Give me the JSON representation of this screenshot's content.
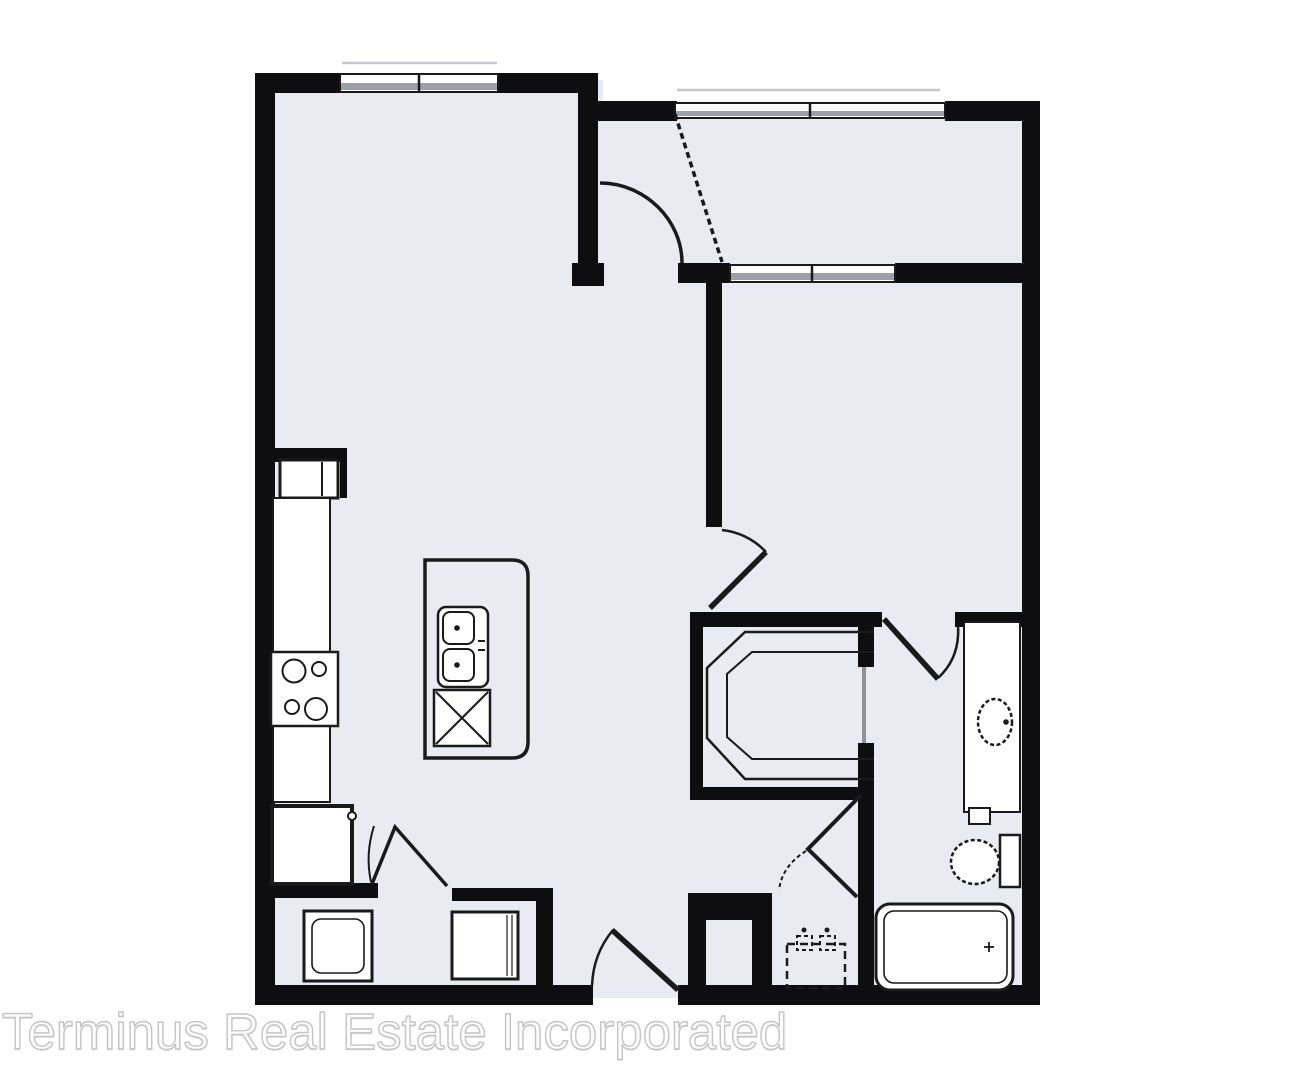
{
  "watermark": {
    "text": "Terminus Real Estate Incorporated"
  },
  "colors": {
    "wall": "#0e0e10",
    "floor": "#e8ebf1",
    "line": "#1a1a1c",
    "window_gray": "#9aa0a8",
    "faint": "#c3c7cd",
    "thin_door": "#8d929a",
    "fixture_fill": "#ffffff",
    "wm_stroke": "#c4c4c4",
    "wm_fill": "#fdfdfd"
  },
  "plan": {
    "type": "apartment-floor-plan",
    "rooms_depicted": [
      "living-dining-room",
      "kitchen",
      "balcony",
      "bedroom",
      "walk-in-closet",
      "bathroom",
      "laundry-closet",
      "utility-closet",
      "entry"
    ],
    "fixtures_depicted": [
      "refrigerator",
      "kitchen-counter",
      "cooktop-4-burners",
      "pantry-cabinet",
      "kitchen-island",
      "double-basin-sink",
      "dishwasher",
      "washer",
      "dryer",
      "bifold-doors",
      "water-heater-dashed",
      "closet-shelf-and-rod",
      "pocket-door",
      "toilet",
      "vanity-with-sink",
      "bathtub"
    ],
    "openings_depicted": [
      "entry-door",
      "balcony-door",
      "bedroom-door",
      "bathroom-door",
      "utility-door",
      "window-living",
      "window-balcony",
      "window-bedroom"
    ]
  }
}
